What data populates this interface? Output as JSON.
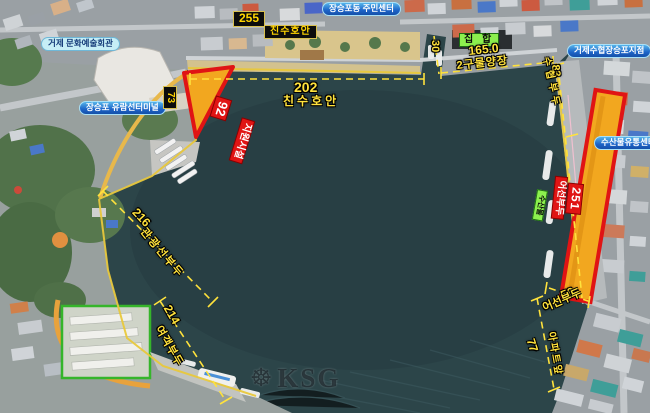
{
  "labels": {
    "arts_center": "거제 문화예술회관",
    "community_center": "장승포동 주민센터",
    "cruise_terminal": "장승포 유람선터미널",
    "suhyup_branch": "거제수협장승포지점",
    "fish_distribution": "수산물유통센터",
    "assembly": "집 합",
    "fish_products": "수산물",
    "len_255": "255",
    "revetment_top": "친수호안",
    "len_73": "73",
    "len_92": "92",
    "support_facility": "지원시설",
    "len_202": "202",
    "revetment_202": "친수호안",
    "len_30": "30",
    "len_165": "165.0",
    "wharf_2gu": "2구물양장",
    "len_83": "83",
    "suhyup_pier": "수협부두",
    "len_251": "251",
    "fishing_pier_red": "어선부두",
    "len_216": "216",
    "tour_pier": "관광선부두",
    "len_214": "214",
    "passenger_pier": "여객부두",
    "len_56": "56",
    "fishing_pier_yellow": "어선부두",
    "len_77": "77",
    "apartment_front": "아파트앞"
  },
  "watermark": {
    "icon": "ship-wheel",
    "text": "KSG"
  },
  "colors": {
    "ann": "#ffe23c",
    "red": "#e01414",
    "zone_fill": "#f2a71f",
    "water": "#2c4549",
    "land": "#9aa0a4"
  }
}
